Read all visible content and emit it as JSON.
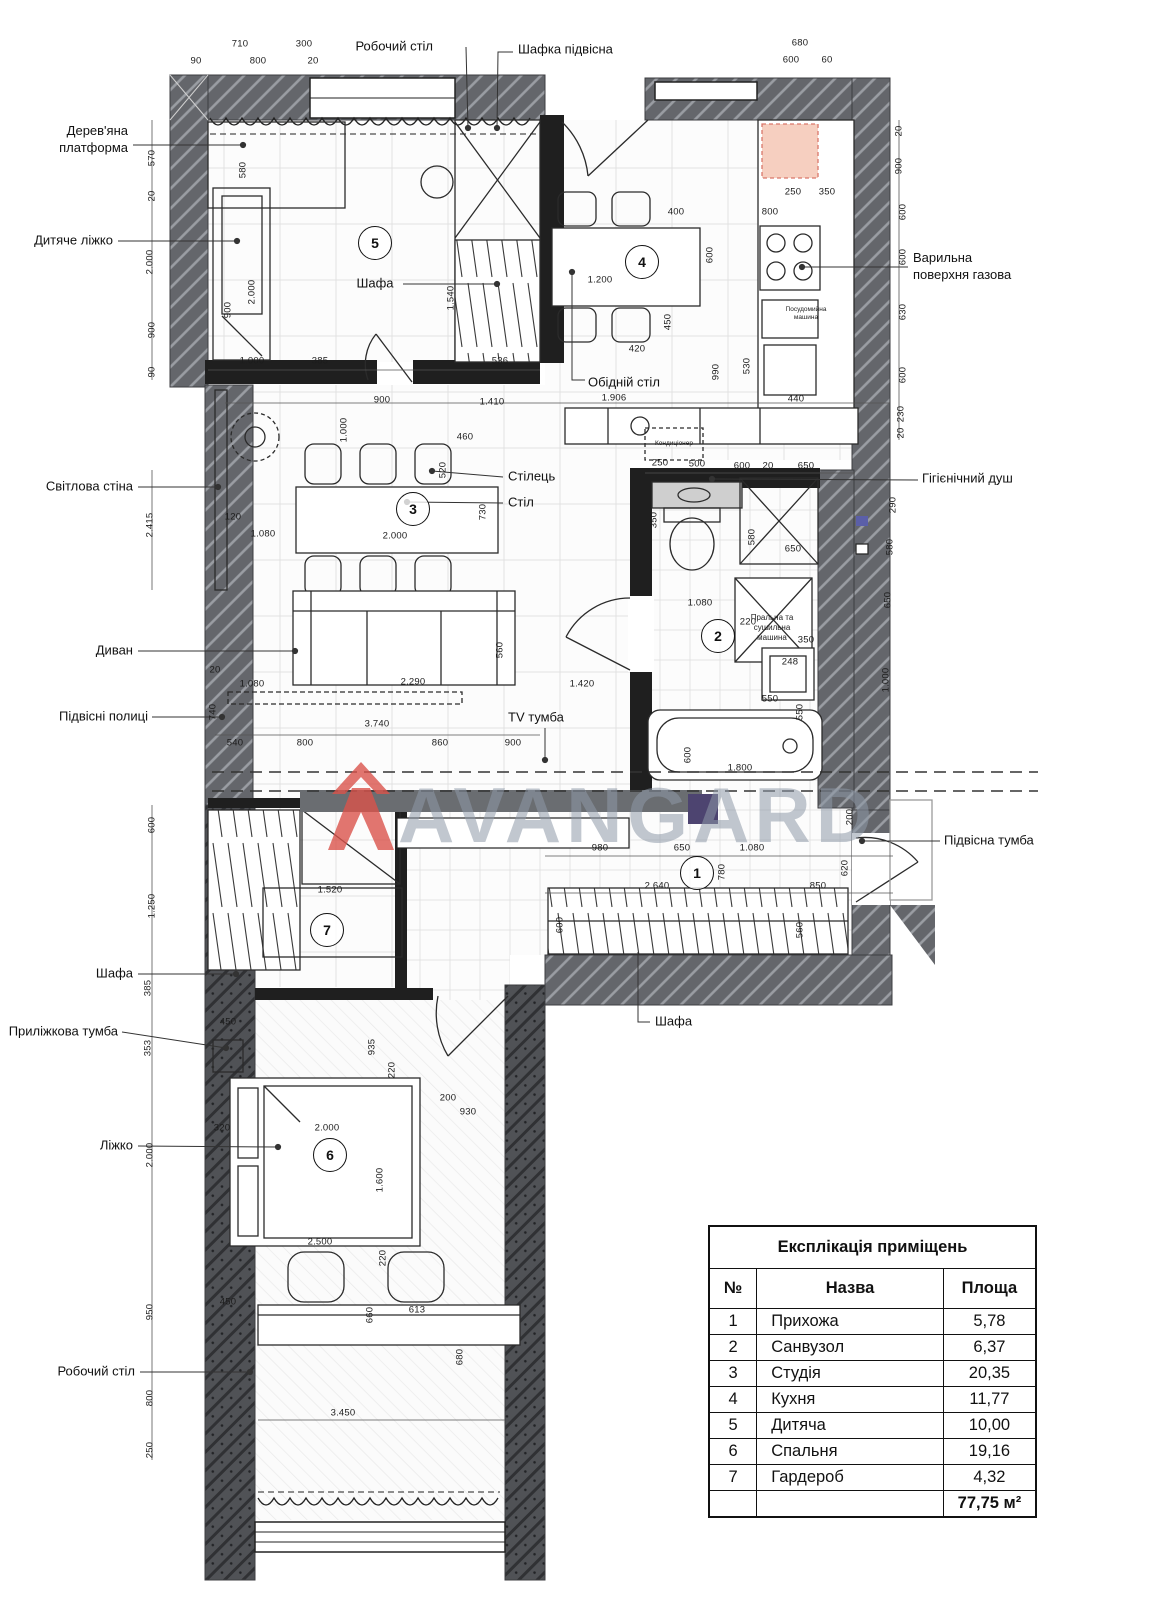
{
  "watermark": {
    "brand": "AVANGARD"
  },
  "colors": {
    "wall_hatch": "#64666b",
    "wall_insulation": "#505256",
    "partition_black": "#1f1f1f",
    "fridge_highlight": "#f6cfc0",
    "fridge_highlight_border": "#d9776a",
    "watermark_red": "#d9534b",
    "watermark_gray": "#8e99a8",
    "tv_panel": "#6a6d71",
    "accent_purple": "#4d4470"
  },
  "legend": {
    "title": "Експлікація приміщень",
    "columns": [
      "№",
      "Назва",
      "Площа"
    ],
    "rows": [
      [
        "1",
        "Прихожа",
        "5,78"
      ],
      [
        "2",
        "Санвузол",
        "6,37"
      ],
      [
        "3",
        "Студія",
        "20,35"
      ],
      [
        "4",
        "Кухня",
        "11,77"
      ],
      [
        "5",
        "Дитяча",
        "10,00"
      ],
      [
        "6",
        "Спальня",
        "19,16"
      ],
      [
        "7",
        "Гардероб",
        "4,32"
      ]
    ],
    "total": "77,75 м²"
  },
  "rooms": [
    {
      "num": "1",
      "x": 697,
      "y": 873
    },
    {
      "num": "2",
      "x": 718,
      "y": 636
    },
    {
      "num": "3",
      "x": 413,
      "y": 509
    },
    {
      "num": "4",
      "x": 642,
      "y": 262
    },
    {
      "num": "5",
      "x": 375,
      "y": 243
    },
    {
      "num": "6",
      "x": 330,
      "y": 1155
    },
    {
      "num": "7",
      "x": 327,
      "y": 930
    }
  ],
  "callouts": [
    {
      "name": "callout-work-desk-top",
      "text": "Робочий стіл",
      "x": 433,
      "y": 47,
      "a": "e"
    },
    {
      "name": "callout-hanging-cabinet",
      "text": "Шафка підвісна",
      "x": 518,
      "y": 50,
      "a": "s"
    },
    {
      "name": "callout-wooden-platform",
      "text": "Дерев'яна\nплатформа",
      "x": 128,
      "y": 140,
      "a": "e"
    },
    {
      "name": "callout-child-bed",
      "text": "Дитяче ліжко",
      "x": 113,
      "y": 241,
      "a": "e"
    },
    {
      "name": "callout-gas-hob",
      "text": "Варильна\nповерхня газова",
      "x": 913,
      "y": 267,
      "a": "s"
    },
    {
      "name": "callout-light-wall",
      "text": "Світлова стіна",
      "x": 133,
      "y": 487,
      "a": "e"
    },
    {
      "name": "callout-chair",
      "text": "Стілець",
      "x": 508,
      "y": 477,
      "a": "s"
    },
    {
      "name": "callout-table",
      "text": "Стіл",
      "x": 508,
      "y": 503,
      "a": "s"
    },
    {
      "name": "callout-hygienic-shower",
      "text": "Гігієнічний душ",
      "x": 922,
      "y": 479,
      "a": "s"
    },
    {
      "name": "callout-dining-table",
      "text": "Обідній стіл",
      "x": 588,
      "y": 383,
      "a": "s"
    },
    {
      "name": "callout-sofa",
      "text": "Диван",
      "x": 133,
      "y": 651,
      "a": "e"
    },
    {
      "name": "callout-hanging-shelves",
      "text": "Підвісні полиці",
      "x": 148,
      "y": 717,
      "a": "e"
    },
    {
      "name": "callout-tv-stand",
      "text": "TV тумба",
      "x": 508,
      "y": 718,
      "a": "s"
    },
    {
      "name": "callout-hanging-vanity",
      "text": "Підвісна тумба",
      "x": 944,
      "y": 841,
      "a": "s"
    },
    {
      "name": "callout-wardrobe-left",
      "text": "Шафа",
      "x": 133,
      "y": 974,
      "a": "e"
    },
    {
      "name": "callout-bedside-cabinet",
      "text": "Приліжкова тумба",
      "x": 118,
      "y": 1032,
      "a": "e"
    },
    {
      "name": "callout-bed",
      "text": "Ліжко",
      "x": 133,
      "y": 1146,
      "a": "e"
    },
    {
      "name": "callout-work-desk-bottom",
      "text": "Робочий стіл",
      "x": 135,
      "y": 1372,
      "a": "e"
    },
    {
      "name": "callout-wardrobe-hall",
      "text": "Шафа",
      "x": 655,
      "y": 1022,
      "a": "s"
    },
    {
      "name": "callout-wardrobe-room5",
      "text": "Шафа",
      "x": 375,
      "y": 284,
      "a": "m"
    }
  ],
  "equipment_texts": [
    {
      "name": "label-air-conditioner",
      "text": "Кондиціонер",
      "x": 674,
      "y": 444,
      "s": 6.5
    },
    {
      "name": "label-washer-dryer",
      "text": "Пральна та\nсушильна\nмашина",
      "x": 772,
      "y": 628,
      "s": 8
    },
    {
      "name": "label-dishwasher",
      "text": "Посудомийна\nмашина",
      "x": 806,
      "y": 314,
      "s": 6.5
    }
  ],
  "dimensions": [
    {
      "t": "710",
      "x": 240,
      "y": 44
    },
    {
      "t": "300",
      "x": 304,
      "y": 44
    },
    {
      "t": "90",
      "x": 196,
      "y": 61
    },
    {
      "t": "800",
      "x": 258,
      "y": 61
    },
    {
      "t": "20",
      "x": 313,
      "y": 61
    },
    {
      "t": "680",
      "x": 800,
      "y": 43
    },
    {
      "t": "600",
      "x": 791,
      "y": 60
    },
    {
      "t": "60",
      "x": 827,
      "y": 60
    },
    {
      "t": "570",
      "x": 152,
      "y": 158,
      "v": 1
    },
    {
      "t": "20",
      "x": 152,
      "y": 196,
      "v": 1
    },
    {
      "t": "2.000",
      "x": 150,
      "y": 262,
      "v": 1
    },
    {
      "t": "900",
      "x": 152,
      "y": 330,
      "v": 1
    },
    {
      "t": "90",
      "x": 152,
      "y": 372,
      "v": 1
    },
    {
      "t": "580",
      "x": 243,
      "y": 170,
      "v": 1
    },
    {
      "t": "900",
      "x": 228,
      "y": 310,
      "v": 1
    },
    {
      "t": "2.000",
      "x": 252,
      "y": 292,
      "v": 1
    },
    {
      "t": "1.540",
      "x": 451,
      "y": 298,
      "v": 1
    },
    {
      "t": "1.000",
      "x": 252,
      "y": 361
    },
    {
      "t": "385",
      "x": 320,
      "y": 361
    },
    {
      "t": "536",
      "x": 500,
      "y": 361
    },
    {
      "t": "900",
      "x": 382,
      "y": 400
    },
    {
      "t": "1.410",
      "x": 492,
      "y": 402
    },
    {
      "t": "1.906",
      "x": 614,
      "y": 398
    },
    {
      "t": "20",
      "x": 899,
      "y": 131,
      "v": 1
    },
    {
      "t": "900",
      "x": 899,
      "y": 166,
      "v": 1
    },
    {
      "t": "600",
      "x": 903,
      "y": 212,
      "v": 1
    },
    {
      "t": "600",
      "x": 903,
      "y": 257,
      "v": 1
    },
    {
      "t": "630",
      "x": 903,
      "y": 312,
      "v": 1
    },
    {
      "t": "600",
      "x": 903,
      "y": 375,
      "v": 1
    },
    {
      "t": "230",
      "x": 901,
      "y": 414,
      "v": 1
    },
    {
      "t": "20",
      "x": 901,
      "y": 433,
      "v": 1
    },
    {
      "t": "250",
      "x": 793,
      "y": 192
    },
    {
      "t": "350",
      "x": 827,
      "y": 192
    },
    {
      "t": "400",
      "x": 676,
      "y": 212
    },
    {
      "t": "800",
      "x": 770,
      "y": 212
    },
    {
      "t": "1.200",
      "x": 600,
      "y": 280
    },
    {
      "t": "600",
      "x": 710,
      "y": 255,
      "v": 1
    },
    {
      "t": "450",
      "x": 668,
      "y": 322,
      "v": 1
    },
    {
      "t": "420",
      "x": 637,
      "y": 349
    },
    {
      "t": "990",
      "x": 716,
      "y": 372,
      "v": 1
    },
    {
      "t": "530",
      "x": 747,
      "y": 366,
      "v": 1
    },
    {
      "t": "440",
      "x": 796,
      "y": 399
    },
    {
      "t": "2.415",
      "x": 150,
      "y": 525,
      "v": 1
    },
    {
      "t": "120",
      "x": 233,
      "y": 517
    },
    {
      "t": "1.080",
      "x": 263,
      "y": 534
    },
    {
      "t": "460",
      "x": 465,
      "y": 437
    },
    {
      "t": "520",
      "x": 443,
      "y": 470,
      "v": 1
    },
    {
      "t": "2.000",
      "x": 395,
      "y": 536
    },
    {
      "t": "730",
      "x": 483,
      "y": 512,
      "v": 1
    },
    {
      "t": "1.000",
      "x": 344,
      "y": 430,
      "v": 1
    },
    {
      "t": "250",
      "x": 660,
      "y": 463
    },
    {
      "t": "500",
      "x": 697,
      "y": 464
    },
    {
      "t": "600",
      "x": 742,
      "y": 466
    },
    {
      "t": "20",
      "x": 768,
      "y": 466
    },
    {
      "t": "650",
      "x": 806,
      "y": 466
    },
    {
      "t": "350",
      "x": 654,
      "y": 520,
      "v": 1
    },
    {
      "t": "580",
      "x": 752,
      "y": 537,
      "v": 1
    },
    {
      "t": "650",
      "x": 793,
      "y": 549
    },
    {
      "t": "1.080",
      "x": 700,
      "y": 603
    },
    {
      "t": "220",
      "x": 748,
      "y": 622
    },
    {
      "t": "350",
      "x": 806,
      "y": 640
    },
    {
      "t": "248",
      "x": 790,
      "y": 662
    },
    {
      "t": "550",
      "x": 770,
      "y": 699
    },
    {
      "t": "290",
      "x": 893,
      "y": 505,
      "v": 1
    },
    {
      "t": "580",
      "x": 890,
      "y": 547,
      "v": 1
    },
    {
      "t": "650",
      "x": 888,
      "y": 600,
      "v": 1
    },
    {
      "t": "1.000",
      "x": 886,
      "y": 680,
      "v": 1
    },
    {
      "t": "600",
      "x": 688,
      "y": 755,
      "v": 1
    },
    {
      "t": "1.800",
      "x": 740,
      "y": 768
    },
    {
      "t": "550",
      "x": 800,
      "y": 712,
      "v": 1
    },
    {
      "t": "20",
      "x": 215,
      "y": 670
    },
    {
      "t": "1.080",
      "x": 252,
      "y": 684
    },
    {
      "t": "2.290",
      "x": 413,
      "y": 682
    },
    {
      "t": "1.420",
      "x": 582,
      "y": 684
    },
    {
      "t": "560",
      "x": 500,
      "y": 650,
      "v": 1
    },
    {
      "t": "740",
      "x": 213,
      "y": 712,
      "v": 1
    },
    {
      "t": "3.740",
      "x": 377,
      "y": 724
    },
    {
      "t": "540",
      "x": 235,
      "y": 743
    },
    {
      "t": "800",
      "x": 305,
      "y": 743
    },
    {
      "t": "860",
      "x": 440,
      "y": 743
    },
    {
      "t": "900",
      "x": 513,
      "y": 743
    },
    {
      "t": "600",
      "x": 152,
      "y": 825,
      "v": 1
    },
    {
      "t": "1.250",
      "x": 152,
      "y": 906,
      "v": 1
    },
    {
      "t": "385",
      "x": 148,
      "y": 988,
      "v": 1
    },
    {
      "t": "353",
      "x": 148,
      "y": 1048,
      "v": 1
    },
    {
      "t": "2.000",
      "x": 150,
      "y": 1155,
      "v": 1
    },
    {
      "t": "950",
      "x": 150,
      "y": 1312,
      "v": 1
    },
    {
      "t": "800",
      "x": 150,
      "y": 1398,
      "v": 1
    },
    {
      "t": "250",
      "x": 150,
      "y": 1450,
      "v": 1
    },
    {
      "t": "980",
      "x": 600,
      "y": 848
    },
    {
      "t": "650",
      "x": 682,
      "y": 848
    },
    {
      "t": "1.080",
      "x": 752,
      "y": 848
    },
    {
      "t": "200",
      "x": 850,
      "y": 817,
      "v": 1
    },
    {
      "t": "780",
      "x": 722,
      "y": 872,
      "v": 1
    },
    {
      "t": "2.640",
      "x": 657,
      "y": 886
    },
    {
      "t": "850",
      "x": 818,
      "y": 886
    },
    {
      "t": "620",
      "x": 845,
      "y": 868,
      "v": 1
    },
    {
      "t": "560",
      "x": 800,
      "y": 930,
      "v": 1
    },
    {
      "t": "600",
      "x": 560,
      "y": 925,
      "v": 1
    },
    {
      "t": "1.520",
      "x": 330,
      "y": 890
    },
    {
      "t": "450",
      "x": 228,
      "y": 1022
    },
    {
      "t": "935",
      "x": 372,
      "y": 1047,
      "v": 1
    },
    {
      "t": "220",
      "x": 392,
      "y": 1070,
      "v": 1
    },
    {
      "t": "320",
      "x": 222,
      "y": 1128
    },
    {
      "t": "2.000",
      "x": 327,
      "y": 1128
    },
    {
      "t": "200",
      "x": 448,
      "y": 1098
    },
    {
      "t": "930",
      "x": 468,
      "y": 1112
    },
    {
      "t": "1.600",
      "x": 380,
      "y": 1180,
      "v": 1
    },
    {
      "t": "2.500",
      "x": 320,
      "y": 1242
    },
    {
      "t": "220",
      "x": 383,
      "y": 1258,
      "v": 1
    },
    {
      "t": "450",
      "x": 228,
      "y": 1302
    },
    {
      "t": "613",
      "x": 417,
      "y": 1310
    },
    {
      "t": "660",
      "x": 370,
      "y": 1315,
      "v": 1
    },
    {
      "t": "680",
      "x": 460,
      "y": 1357,
      "v": 1
    },
    {
      "t": "3.450",
      "x": 343,
      "y": 1413
    }
  ]
}
